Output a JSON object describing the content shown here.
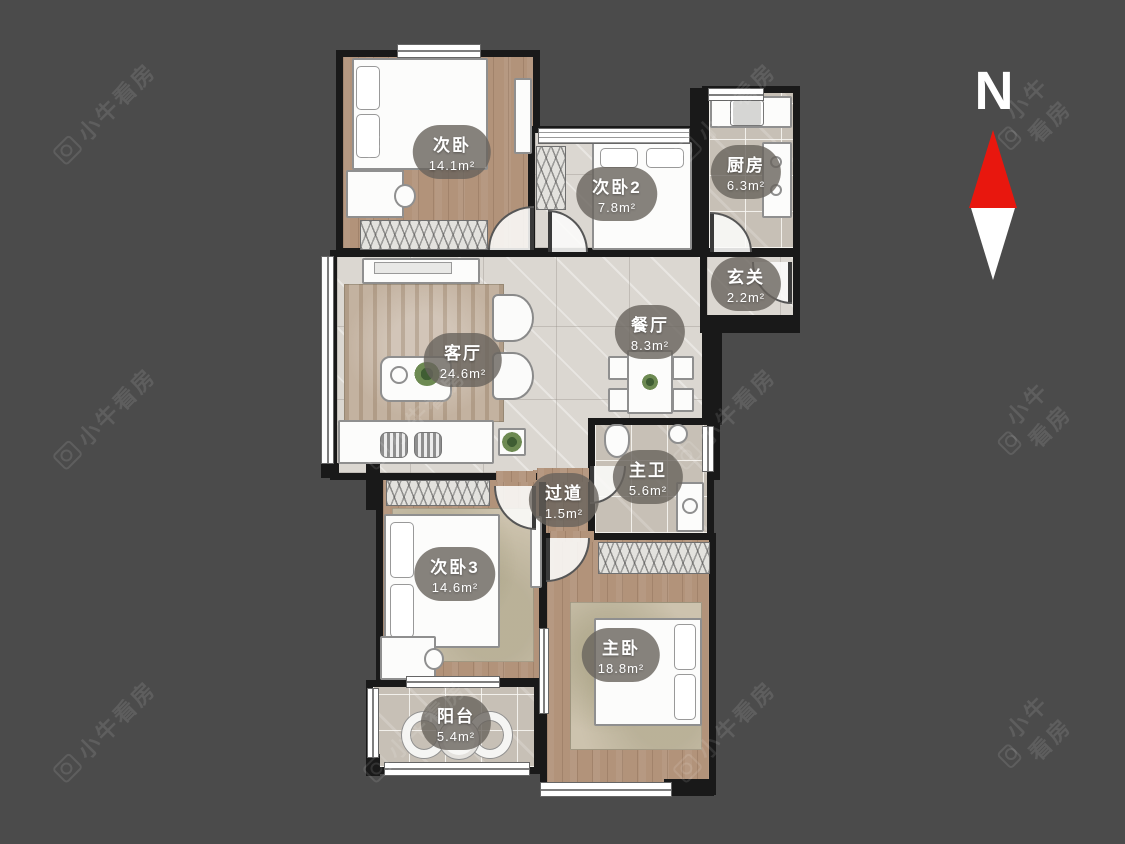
{
  "page": {
    "background_color": "#4b4b4b"
  },
  "watermark": {
    "text": "小牛看房",
    "icon": "camera-logo-icon",
    "color": "#ffffff"
  },
  "compass": {
    "label": "N",
    "north_color": "#e8170e",
    "south_color": "#ffffff"
  },
  "colors": {
    "wall": "#191919",
    "wood_floor": "#b2937a",
    "marble_floor": "#dbd7d1",
    "gray_tile_floor": "#c7c0b6",
    "label_pill": "rgba(104,99,92,0.80)"
  },
  "floorplan": {
    "rooms": [
      {
        "id": "bedroom1",
        "name": "次卧",
        "area": "14.1m²"
      },
      {
        "id": "bedroom2",
        "name": "次卧2",
        "area": "7.8m²"
      },
      {
        "id": "kitchen",
        "name": "厨房",
        "area": "6.3m²"
      },
      {
        "id": "entry",
        "name": "玄关",
        "area": "2.2m²"
      },
      {
        "id": "living",
        "name": "客厅",
        "area": "24.6m²"
      },
      {
        "id": "dining",
        "name": "餐厅",
        "area": "8.3m²"
      },
      {
        "id": "master-bath",
        "name": "主卫",
        "area": "5.6m²"
      },
      {
        "id": "hallway",
        "name": "过道",
        "area": "1.5m²"
      },
      {
        "id": "bedroom3",
        "name": "次卧3",
        "area": "14.6m²"
      },
      {
        "id": "master-bedroom",
        "name": "主卧",
        "area": "18.8m²"
      },
      {
        "id": "balcony",
        "name": "阳台",
        "area": "5.4m²"
      }
    ]
  }
}
